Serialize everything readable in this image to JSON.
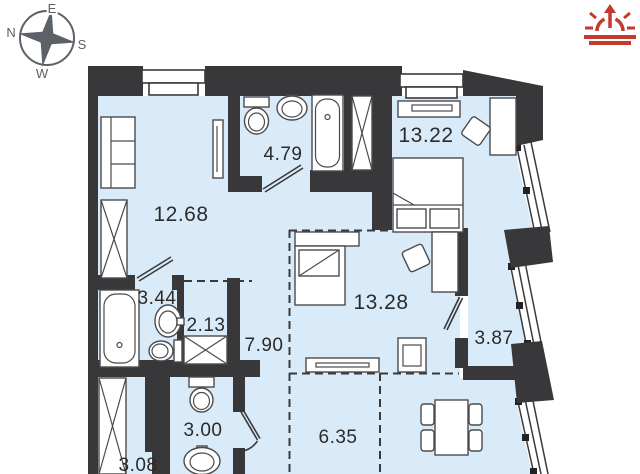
{
  "title": "apartment floor plan",
  "colors": {
    "wall": "#38383a",
    "floor_fill": "#d9eaf8",
    "logo_red": "#c23b2e",
    "compass_gray": "#5b6166",
    "label_text": "#2b2b2b"
  },
  "icons": [
    {
      "name": "compass-rose-icon"
    },
    {
      "name": "sunrise-logo-icon"
    }
  ],
  "compass": {
    "north": "N",
    "east": "E",
    "south": "S",
    "west": "W"
  },
  "plan": {
    "rooms": [
      {
        "area": "12.68"
      },
      {
        "area": "4.79"
      },
      {
        "area": "13.22"
      },
      {
        "area": "3.44"
      },
      {
        "area": "2.13"
      },
      {
        "area": "7.90"
      },
      {
        "area": "13.28"
      },
      {
        "area": "3.87"
      },
      {
        "area": "3.00"
      },
      {
        "area": "6.35"
      },
      {
        "area": "3.08"
      }
    ]
  }
}
